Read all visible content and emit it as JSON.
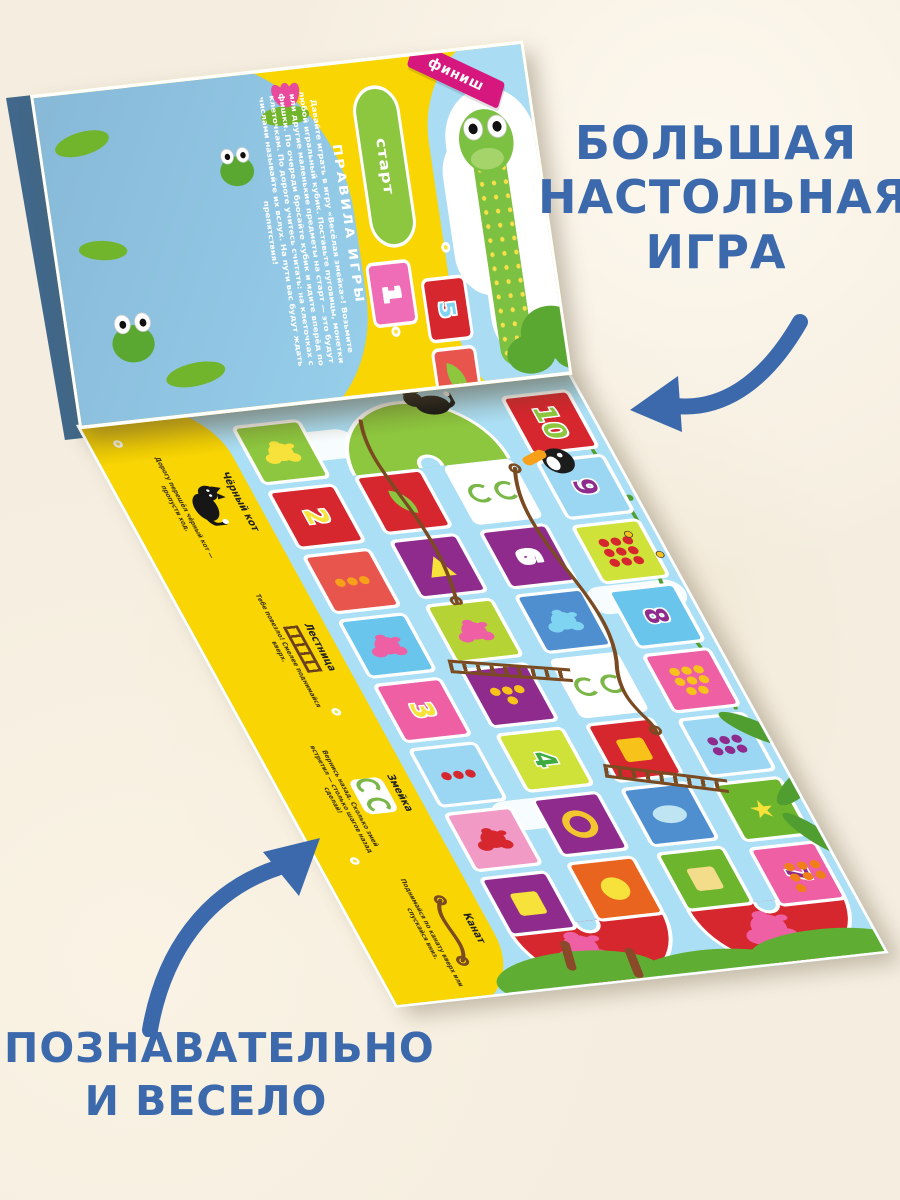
{
  "page": {
    "background": "#f5eee0"
  },
  "promo": {
    "accent_color": "#3b69ac",
    "headline_top_lines": [
      "БОЛЬШАЯ",
      "НАСТОЛЬНАЯ",
      "ИГРА"
    ],
    "headline_bottom_lines": [
      "ПОЗНАВАТЕЛЬНО",
      "И ВЕСЕЛО"
    ]
  },
  "board": {
    "rules": {
      "heading": "ПРАВИЛА ИГРЫ",
      "body": "Давайте играть в игру «Весёлая змейка»! Возьмите любой игральный кубик. Поставьте пуговицы, монетки или другие маленькие предметы на старт — это будут фишки. По очереди бросайте кубик и идите вперёд по клеточкам. По дороге учитесь считать: на клеточках с числами называйте их вслух. На пути вас будут ждать препятствия!"
    },
    "start_label": "старт",
    "finish_label": "финиш",
    "legend": [
      {
        "icon": "black-cat",
        "title": "Чёрный кот",
        "text": "Дорогу перешёл чёрный кот — пропусти ход."
      },
      {
        "icon": "ladder",
        "title": "Лестница",
        "text": "Тебе повезло! Смелее поднимайся вверх."
      },
      {
        "icon": "snakes",
        "title": "Змейка",
        "text": "Вернись назад. Сколько змей встретил — столько шагов назад сделай!"
      },
      {
        "icon": "rope",
        "title": "Канат",
        "text": "Поднимайся по канату вверх или спускайся вниз."
      }
    ],
    "start_cells": [
      {
        "num": "1",
        "bg": "#ef6db6",
        "fg": "#ffffff"
      },
      {
        "num": "5",
        "bg": "#d6262e",
        "fg": "#7fd4f2"
      },
      {
        "icon": "leaf",
        "bg": "#e8554d",
        "c": "#8dc63f"
      },
      {
        "icon": "dots",
        "n": 5,
        "bg": "#f3c52f",
        "c": "#c2387e"
      }
    ],
    "path_columns": [
      [
        {
          "icon": "splat",
          "bg": "#8dc63f",
          "c": "#f7e23b"
        },
        {
          "num": "2",
          "bg": "#d6262e",
          "fg": "#f7e23b"
        },
        {
          "icon": "dots",
          "n": 3,
          "bg": "#e8554d",
          "c": "#f7a11b"
        },
        {
          "icon": "splat",
          "bg": "#6ac5ec",
          "c": "#ee5fa4"
        },
        {
          "num": "3",
          "bg": "#ee5fa4",
          "fg": "#f7e23b"
        },
        {
          "icon": "dots",
          "n": 3,
          "bg": "#9bd7f2",
          "c": "#d6262e"
        },
        {
          "icon": "splat",
          "bg": "#f19ac5",
          "c": "#d6262e"
        },
        {
          "icon": "square",
          "bg": "#8e2b8c",
          "c": "#f7e23b"
        }
      ],
      [
        {
          "icon": "leaf",
          "bg": "#d6262e",
          "c": "#8dc63f"
        },
        {
          "icon": "triangle",
          "bg": "#8e2b8c",
          "c": "#f7e23b"
        },
        {
          "icon": "splat",
          "bg": "#b5d334",
          "c": "#ee5fa4"
        },
        {
          "icon": "dots",
          "n": 4,
          "bg": "#8e2b8c",
          "c": "#f7c31b"
        },
        {
          "num": "4",
          "bg": "#cfe23a",
          "fg": "#3faa3f"
        },
        {
          "icon": "ring",
          "bg": "#8e2b8c",
          "c": "#f3c52f"
        },
        {
          "icon": "circle",
          "bg": "#e8641f",
          "c": "#f7e23b"
        }
      ],
      [
        {
          "icon": "spiral",
          "bg": "#ffffff",
          "c": "#7ab648"
        },
        {
          "num": "6",
          "bg": "#8e2b8c",
          "fg": "#ffffff"
        },
        {
          "icon": "splat",
          "bg": "#4f8fd0",
          "c": "#7fd4f2"
        },
        {
          "icon": "spiral",
          "bg": "#ffffff",
          "c": "#7ab648"
        },
        {
          "icon": "square",
          "bg": "#d6262e",
          "c": "#f7c31b"
        },
        {
          "icon": "ellipse",
          "bg": "#4f8fd0",
          "c": "#bfe4f2"
        },
        {
          "icon": "square",
          "bg": "#6db52c",
          "c": "#f3dd8a"
        }
      ],
      [
        {
          "num": "10",
          "bg": "#d6262e",
          "fg": "#8dc63f"
        },
        {
          "num": "9",
          "bg": "#9bd7f2",
          "fg": "#8e2b8c"
        },
        {
          "icon": "dots",
          "n": 9,
          "bg": "#cfe23a",
          "c": "#d6262e"
        },
        {
          "num": "8",
          "bg": "#6ac5ec",
          "fg": "#8e2b8c"
        },
        {
          "icon": "dots",
          "n": 8,
          "bg": "#ee5fa4",
          "c": "#f7c31b"
        },
        {
          "icon": "dots",
          "n": 6,
          "bg": "#9bd7f2",
          "c": "#8e2b8c"
        },
        {
          "icon": "star",
          "bg": "#6db52c",
          "c": "#f7e23b"
        },
        {
          "num": "7",
          "bg": "#ee5fa4",
          "fg": "#8e2b8c"
        }
      ]
    ]
  }
}
